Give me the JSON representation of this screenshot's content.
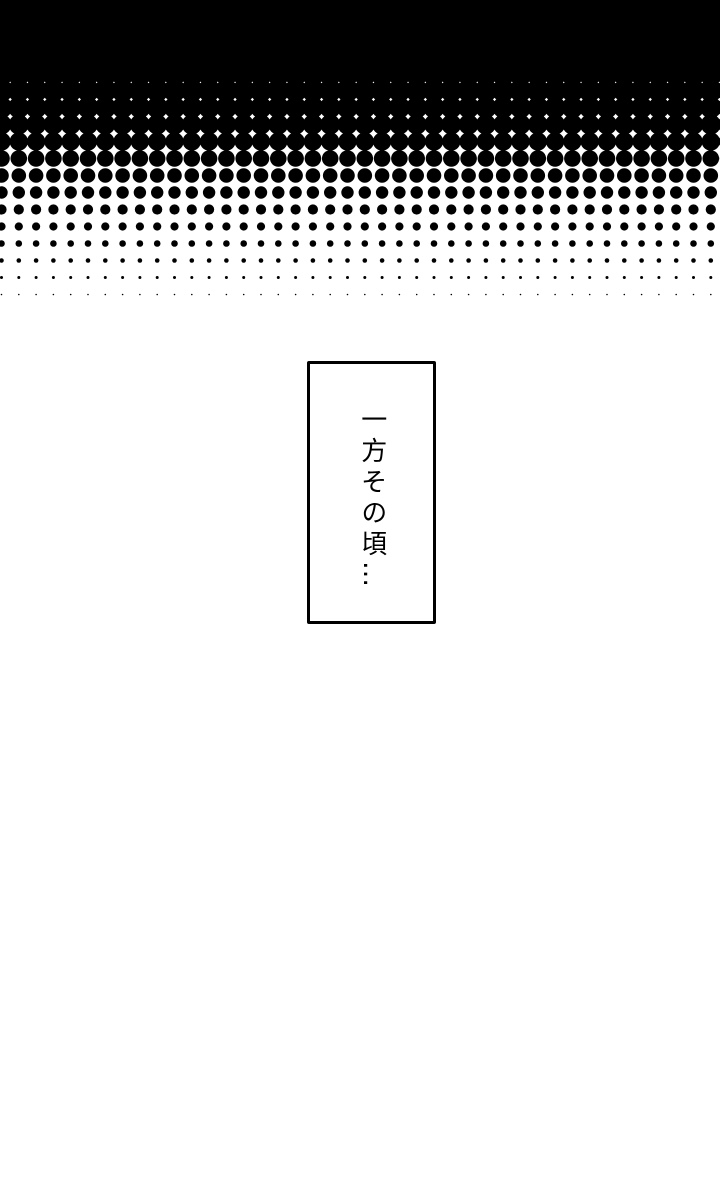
{
  "page": {
    "kind": "manga-page",
    "paper_color": "#ffffff",
    "ink_color": "#000000"
  },
  "screentone": {
    "name": "halftone-fade-black-to-white",
    "ink_color": "#000000",
    "solid_band_height": 70,
    "dot_spacing_x": 17.3,
    "dot_spacing_y": 17,
    "origin_x": 1.5,
    "first_row_y": 73.5,
    "row_radii": [
      11.8,
      11.3,
      10.7,
      10.0,
      9.2,
      8.3,
      7.3,
      6.2,
      5.1,
      4.1,
      3.3,
      2.3,
      1.5,
      0.8
    ],
    "area_width": 720,
    "area_height": 300
  },
  "caption": {
    "text": "一方その頃…"
  }
}
